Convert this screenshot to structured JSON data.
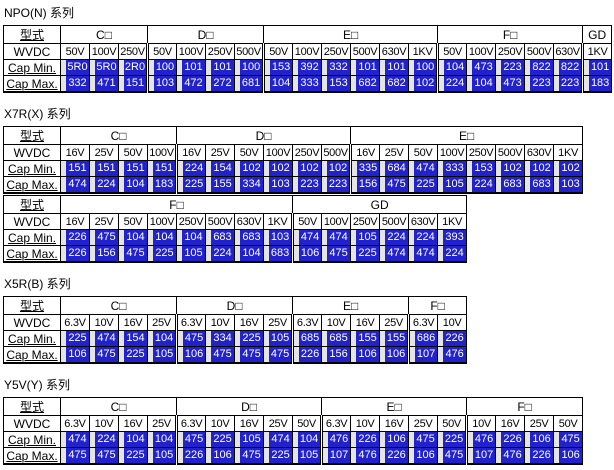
{
  "colors": {
    "value_bg": "#2222cc",
    "value_text": "#ffffff",
    "border": "#000000"
  },
  "row_labels": {
    "type": "型式",
    "wvdc": "WVDC",
    "cap_min": "Cap Min.",
    "cap_max": "Cap Max."
  },
  "sections": [
    {
      "title": "NPO(N) 系列",
      "tables": [
        {
          "groups": [
            {
              "label": "C□",
              "columns": [
                {
                  "wvdc": "50V",
                  "min": "5R0",
                  "max": "332"
                },
                {
                  "wvdc": "100V",
                  "min": "5R0",
                  "max": "471"
                },
                {
                  "wvdc": "250V",
                  "min": "2R0",
                  "max": "151"
                }
              ]
            },
            {
              "label": "D□",
              "columns": [
                {
                  "wvdc": "50V",
                  "min": "100",
                  "max": "103"
                },
                {
                  "wvdc": "100V",
                  "min": "101",
                  "max": "472"
                },
                {
                  "wvdc": "250V",
                  "min": "101",
                  "max": "272"
                },
                {
                  "wvdc": "500V",
                  "min": "100",
                  "max": "681"
                }
              ]
            },
            {
              "label": "E□",
              "columns": [
                {
                  "wvdc": "50V",
                  "min": "153",
                  "max": "104"
                },
                {
                  "wvdc": "100V",
                  "min": "392",
                  "max": "333"
                },
                {
                  "wvdc": "250V",
                  "min": "332",
                  "max": "153"
                },
                {
                  "wvdc": "500V",
                  "min": "101",
                  "max": "682"
                },
                {
                  "wvdc": "630V",
                  "min": "101",
                  "max": "682"
                },
                {
                  "wvdc": "1KV",
                  "min": "100",
                  "max": "102"
                }
              ]
            },
            {
              "label": "F□",
              "columns": [
                {
                  "wvdc": "50V",
                  "min": "104",
                  "max": "224"
                },
                {
                  "wvdc": "100V",
                  "min": "473",
                  "max": "104"
                },
                {
                  "wvdc": "250V",
                  "min": "223",
                  "max": "473"
                },
                {
                  "wvdc": "500V",
                  "min": "822",
                  "max": "223"
                },
                {
                  "wvdc": "630V",
                  "min": "822",
                  "max": "223"
                }
              ]
            },
            {
              "label": "GD",
              "columns": [
                {
                  "wvdc": "1KV",
                  "min": "101",
                  "max": "183"
                }
              ]
            }
          ]
        }
      ]
    },
    {
      "title": "X7R(X) 系列",
      "tables": [
        {
          "groups": [
            {
              "label": "C□",
              "columns": [
                {
                  "wvdc": "16V",
                  "min": "151",
                  "max": "474"
                },
                {
                  "wvdc": "25V",
                  "min": "151",
                  "max": "224"
                },
                {
                  "wvdc": "50V",
                  "min": "151",
                  "max": "104"
                },
                {
                  "wvdc": "100V",
                  "min": "151",
                  "max": "183"
                }
              ]
            },
            {
              "label": "D□",
              "columns": [
                {
                  "wvdc": "16V",
                  "min": "224",
                  "max": "225"
                },
                {
                  "wvdc": "25V",
                  "min": "154",
                  "max": "155"
                },
                {
                  "wvdc": "50V",
                  "min": "102",
                  "max": "334"
                },
                {
                  "wvdc": "100V",
                  "min": "102",
                  "max": "103"
                },
                {
                  "wvdc": "250V",
                  "min": "102",
                  "max": "223"
                },
                {
                  "wvdc": "500V",
                  "min": "102",
                  "max": "223"
                }
              ]
            },
            {
              "label": "E□",
              "columns": [
                {
                  "wvdc": "16V",
                  "min": "335",
                  "max": "156"
                },
                {
                  "wvdc": "25V",
                  "min": "684",
                  "max": "475"
                },
                {
                  "wvdc": "50V",
                  "min": "474",
                  "max": "225"
                },
                {
                  "wvdc": "100V",
                  "min": "333",
                  "max": "105"
                },
                {
                  "wvdc": "250V",
                  "min": "153",
                  "max": "224"
                },
                {
                  "wvdc": "500V",
                  "min": "102",
                  "max": "683"
                },
                {
                  "wvdc": "630V",
                  "min": "102",
                  "max": "683"
                },
                {
                  "wvdc": "1KV",
                  "min": "102",
                  "max": "103"
                }
              ]
            }
          ]
        },
        {
          "groups": [
            {
              "label": "F□",
              "columns": [
                {
                  "wvdc": "16V",
                  "min": "226",
                  "max": "226"
                },
                {
                  "wvdc": "25V",
                  "min": "475",
                  "max": "156"
                },
                {
                  "wvdc": "50V",
                  "min": "104",
                  "max": "475"
                },
                {
                  "wvdc": "100V",
                  "min": "104",
                  "max": "225"
                },
                {
                  "wvdc": "250V",
                  "min": "104",
                  "max": "105"
                },
                {
                  "wvdc": "500V",
                  "min": "683",
                  "max": "224"
                },
                {
                  "wvdc": "630V",
                  "min": "683",
                  "max": "104"
                },
                {
                  "wvdc": "1KV",
                  "min": "103",
                  "max": "683"
                }
              ]
            },
            {
              "label": "GD",
              "columns": [
                {
                  "wvdc": "50V",
                  "min": "474",
                  "max": "106"
                },
                {
                  "wvdc": "100V",
                  "min": "474",
                  "max": "475"
                },
                {
                  "wvdc": "250V",
                  "min": "105",
                  "max": "225"
                },
                {
                  "wvdc": "500V",
                  "min": "224",
                  "max": "474"
                },
                {
                  "wvdc": "630V",
                  "min": "224",
                  "max": "474"
                },
                {
                  "wvdc": "1KV",
                  "min": "393",
                  "max": "224"
                }
              ]
            }
          ]
        }
      ]
    },
    {
      "title": "X5R(B) 系列",
      "tables": [
        {
          "groups": [
            {
              "label": "C□",
              "columns": [
                {
                  "wvdc": "6.3V",
                  "min": "225",
                  "max": "106"
                },
                {
                  "wvdc": "10V",
                  "min": "474",
                  "max": "475"
                },
                {
                  "wvdc": "16V",
                  "min": "154",
                  "max": "225"
                },
                {
                  "wvdc": "25V",
                  "min": "104",
                  "max": "105"
                }
              ]
            },
            {
              "label": "D□",
              "columns": [
                {
                  "wvdc": "6.3V",
                  "min": "475",
                  "max": "106"
                },
                {
                  "wvdc": "10V",
                  "min": "334",
                  "max": "475"
                },
                {
                  "wvdc": "16V",
                  "min": "225",
                  "max": "475"
                },
                {
                  "wvdc": "25V",
                  "min": "105",
                  "max": "475"
                }
              ]
            },
            {
              "label": "E□",
              "columns": [
                {
                  "wvdc": "6.3V",
                  "min": "685",
                  "max": "226"
                },
                {
                  "wvdc": "10V",
                  "min": "685",
                  "max": "156"
                },
                {
                  "wvdc": "16V",
                  "min": "155",
                  "max": "106"
                },
                {
                  "wvdc": "25V",
                  "min": "155",
                  "max": "106"
                }
              ]
            },
            {
              "label": "F□",
              "columns": [
                {
                  "wvdc": "6.3V",
                  "min": "686",
                  "max": "107"
                },
                {
                  "wvdc": "10V",
                  "min": "226",
                  "max": "476"
                }
              ]
            }
          ]
        }
      ]
    },
    {
      "title": "Y5V(Y) 系列",
      "tables": [
        {
          "groups": [
            {
              "label": "C□",
              "columns": [
                {
                  "wvdc": "6.3V",
                  "min": "474",
                  "max": "475"
                },
                {
                  "wvdc": "10V",
                  "min": "224",
                  "max": "475"
                },
                {
                  "wvdc": "16V",
                  "min": "104",
                  "max": "225"
                },
                {
                  "wvdc": "25V",
                  "min": "104",
                  "max": "105"
                }
              ]
            },
            {
              "label": "D□",
              "columns": [
                {
                  "wvdc": "6.3V",
                  "min": "475",
                  "max": "226"
                },
                {
                  "wvdc": "10V",
                  "min": "225",
                  "max": "106"
                },
                {
                  "wvdc": "16V",
                  "min": "105",
                  "max": "475"
                },
                {
                  "wvdc": "25V",
                  "min": "474",
                  "max": "225"
                },
                {
                  "wvdc": "50V",
                  "min": "104",
                  "max": "105"
                }
              ]
            },
            {
              "label": "E□",
              "columns": [
                {
                  "wvdc": "6.3V",
                  "min": "476",
                  "max": "107"
                },
                {
                  "wvdc": "10V",
                  "min": "226",
                  "max": "476"
                },
                {
                  "wvdc": "16V",
                  "min": "106",
                  "max": "226"
                },
                {
                  "wvdc": "25V",
                  "min": "475",
                  "max": "106"
                },
                {
                  "wvdc": "50V",
                  "min": "225",
                  "max": "475"
                }
              ]
            },
            {
              "label": "F□",
              "columns": [
                {
                  "wvdc": "10V",
                  "min": "476",
                  "max": "107"
                },
                {
                  "wvdc": "16V",
                  "min": "226",
                  "max": "476"
                },
                {
                  "wvdc": "25V",
                  "min": "106",
                  "max": "226"
                },
                {
                  "wvdc": "50V",
                  "min": "475",
                  "max": "106"
                }
              ]
            }
          ]
        }
      ]
    }
  ]
}
